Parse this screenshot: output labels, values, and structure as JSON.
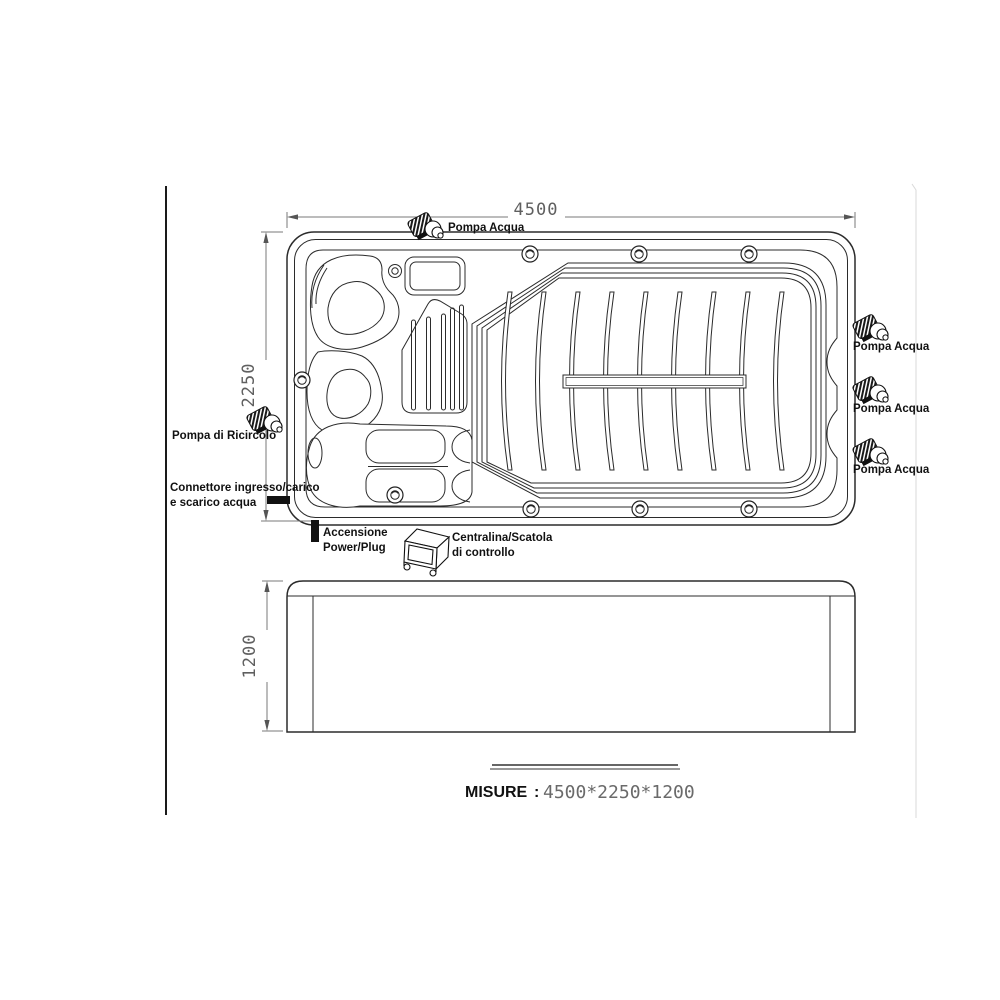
{
  "drawing": {
    "type": "technical-drawing-swim-spa",
    "views": [
      "top-view",
      "side-view"
    ]
  },
  "labels": {
    "pompa_acqua": "Pompa Acqua",
    "pompa_di_ricircolo": "Pompa di Ricircolo",
    "connettore_riga1": "Connettore ingresso/carico",
    "connettore_riga2": "e scarico acqua",
    "accensione_riga1": "Accensione",
    "accensione_riga2": "Power/Plug",
    "centralina_riga1": "Centralina/Scatola",
    "centralina_riga2": "di controllo"
  },
  "dimensions": {
    "width": "4500",
    "depth": "2250",
    "height": "1200"
  },
  "footer": {
    "label": "MISURE",
    "separator": ":",
    "value": "4500*2250*1200"
  },
  "icons": {
    "water_pump": "water-pump-icon",
    "recirculation_pump": "recirculation-pump-icon",
    "control_box": "control-box-icon",
    "connector_bar": "connector-bar-icon",
    "power_plug_bar": "power-plug-bar-icon",
    "screw": "screw-icon",
    "jet": "jet-icon"
  },
  "colors": {
    "line": "#2b2b2b",
    "dimension_text": "#5f5f5f",
    "faint_border": "#d9d9d9",
    "background": "#ffffff"
  }
}
